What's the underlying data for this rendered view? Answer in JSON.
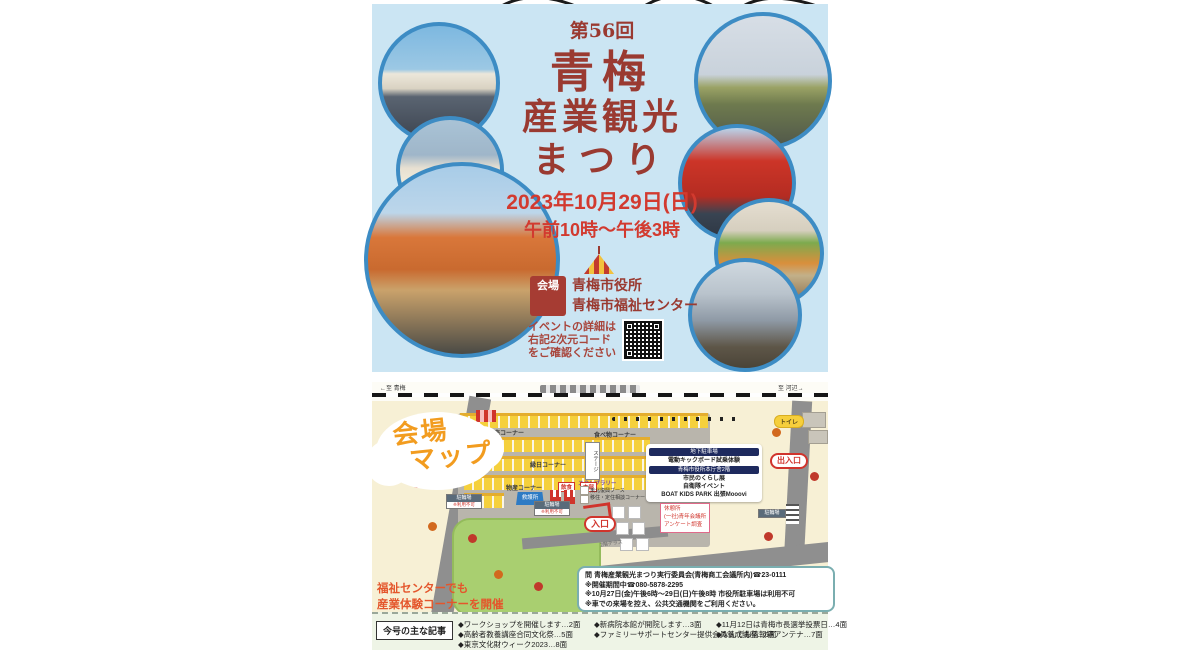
{
  "colors": {
    "poster_bg": "#cbe5f3",
    "circle_border": "#3d8cc4",
    "title_red": "#9a3a31",
    "date_red": "#d23a2f",
    "map_cream": "#f7f0d5",
    "tent_yellow": "#f5d03c",
    "heading_orange": "#f29c1f",
    "welfare_orange": "#e4562c"
  },
  "poster": {
    "edition": "第56回",
    "title_lines": [
      "青梅",
      "産業観光",
      "まつり"
    ],
    "date": "2023年10月29日(日)",
    "time": "午前10時〜午後3時",
    "venue_label": "会場",
    "venue_lines": [
      "青梅市役所",
      "青梅市福祉センター"
    ],
    "qr_note_lines": [
      "イベントの詳細は",
      "右記2次元コード",
      "をご確認ください"
    ]
  },
  "map": {
    "heading_lines": [
      "会場",
      "マップ"
    ],
    "rail_left": "←至 青梅",
    "rail_right": "至 河辺→",
    "labels": {
      "products_sale": "物産販売コーナー",
      "food": "食べ物コーナー",
      "ennichi": "縁日コーナー",
      "products": "物産コーナー",
      "stage": "ステージ",
      "stamp_rally": "スタンプラリー",
      "eat": "飲食",
      "hq": "本部",
      "first_aid": "救護所",
      "bike_parking": "駐輪場",
      "bike_parking_note": "※利用不可",
      "toilet": "トイレ",
      "exit": "出入口",
      "entrance": "入口",
      "tohoku_booth": "東北復興ブース",
      "consult_corner": "移住・定住相談コーナー",
      "terrace": "2階テラス"
    },
    "info_box": {
      "sections": [
        {
          "header": "地下駐車場",
          "items": [
            "電動キックボード試乗体験"
          ]
        },
        {
          "header": "青梅市役所本庁舎2階",
          "items": [
            "市民のくらし展",
            "自衛隊イベント",
            "BOAT KIDS PARK 出張Mooovi"
          ]
        }
      ]
    },
    "rest_box_lines": [
      "休憩所",
      "(一社)青年会議所",
      "アンケート調査"
    ],
    "welfare_note_lines": [
      "福祉センターでも",
      "産業体験コーナーを開催"
    ]
  },
  "contact": {
    "lines": [
      "問 青梅産業観光まつり実行委員会(青梅商工会議所内)☎23-0111",
      "※開催期間中☎080-5878-2295",
      "※10月27日(金)午後6時〜29日(日)午後8時 市役所駐車場は利用不可",
      "※車での来場を控え、公共交通機関をご利用ください。"
    ]
  },
  "articles": {
    "header": "今号の主な記事",
    "columns": [
      [
        "◆ワークショップを開催します…2面",
        "◆高齢者教養講座合同文化祭…5面",
        "◆東京文化財ウィーク2023…8面"
      ],
      [
        "◆新病院本館が開院します…3面",
        "◆ファミリーサポートセンター提供会員養成講座…6面"
      ],
      [
        "◆11月12日は青梅市長選挙投票日…4面",
        "◆なんでも情報箱アンテナ…7面"
      ]
    ]
  }
}
